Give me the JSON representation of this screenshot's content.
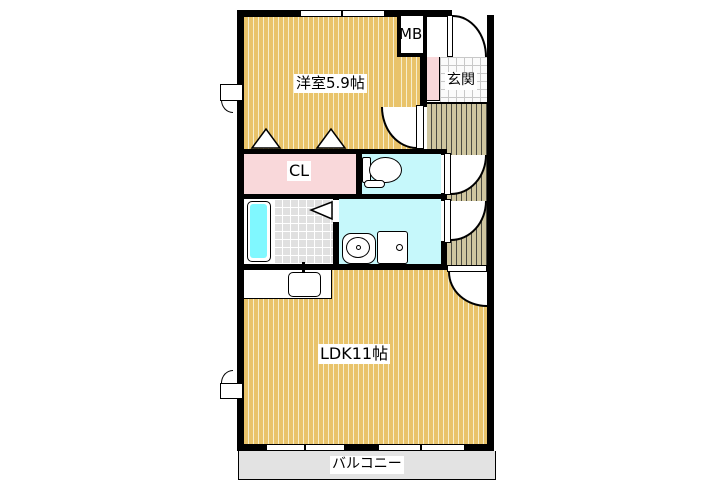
{
  "document_type": "apartment-floor-plan",
  "labels": {
    "western_room": "洋室5.9帖",
    "meter_box": "MB",
    "entrance": "玄関",
    "closet": "CL",
    "ldk": "LDK11帖",
    "balcony": "バルコニー"
  },
  "rooms": [
    {
      "name": "洋室5.9帖",
      "type": "western-room",
      "size_jo": 5.9
    },
    {
      "name": "LDK11帖",
      "type": "living-dining-kitchen",
      "size_jo": 11
    },
    {
      "name": "玄関",
      "type": "entrance"
    },
    {
      "name": "CL",
      "type": "closet"
    },
    {
      "name": "MB",
      "type": "meter-box"
    },
    {
      "name": "バルコニー",
      "type": "balcony"
    }
  ],
  "colors": {
    "wood_floor": "#e9c36a",
    "wood_stripe": "#f6eecd",
    "hall_floor": "#cfc6a0",
    "hall_stripe": "#4a4a42",
    "closet_pink": "#f9d8da",
    "wet_area_cyan": "#c6f8fb",
    "bathtub_cyan": "#80f8ff",
    "bath_tile_gray": "#e0e0e0",
    "entrance_tile": "#fbfbfb",
    "balcony_gray": "#e3e3e3",
    "wall": "#000000"
  }
}
